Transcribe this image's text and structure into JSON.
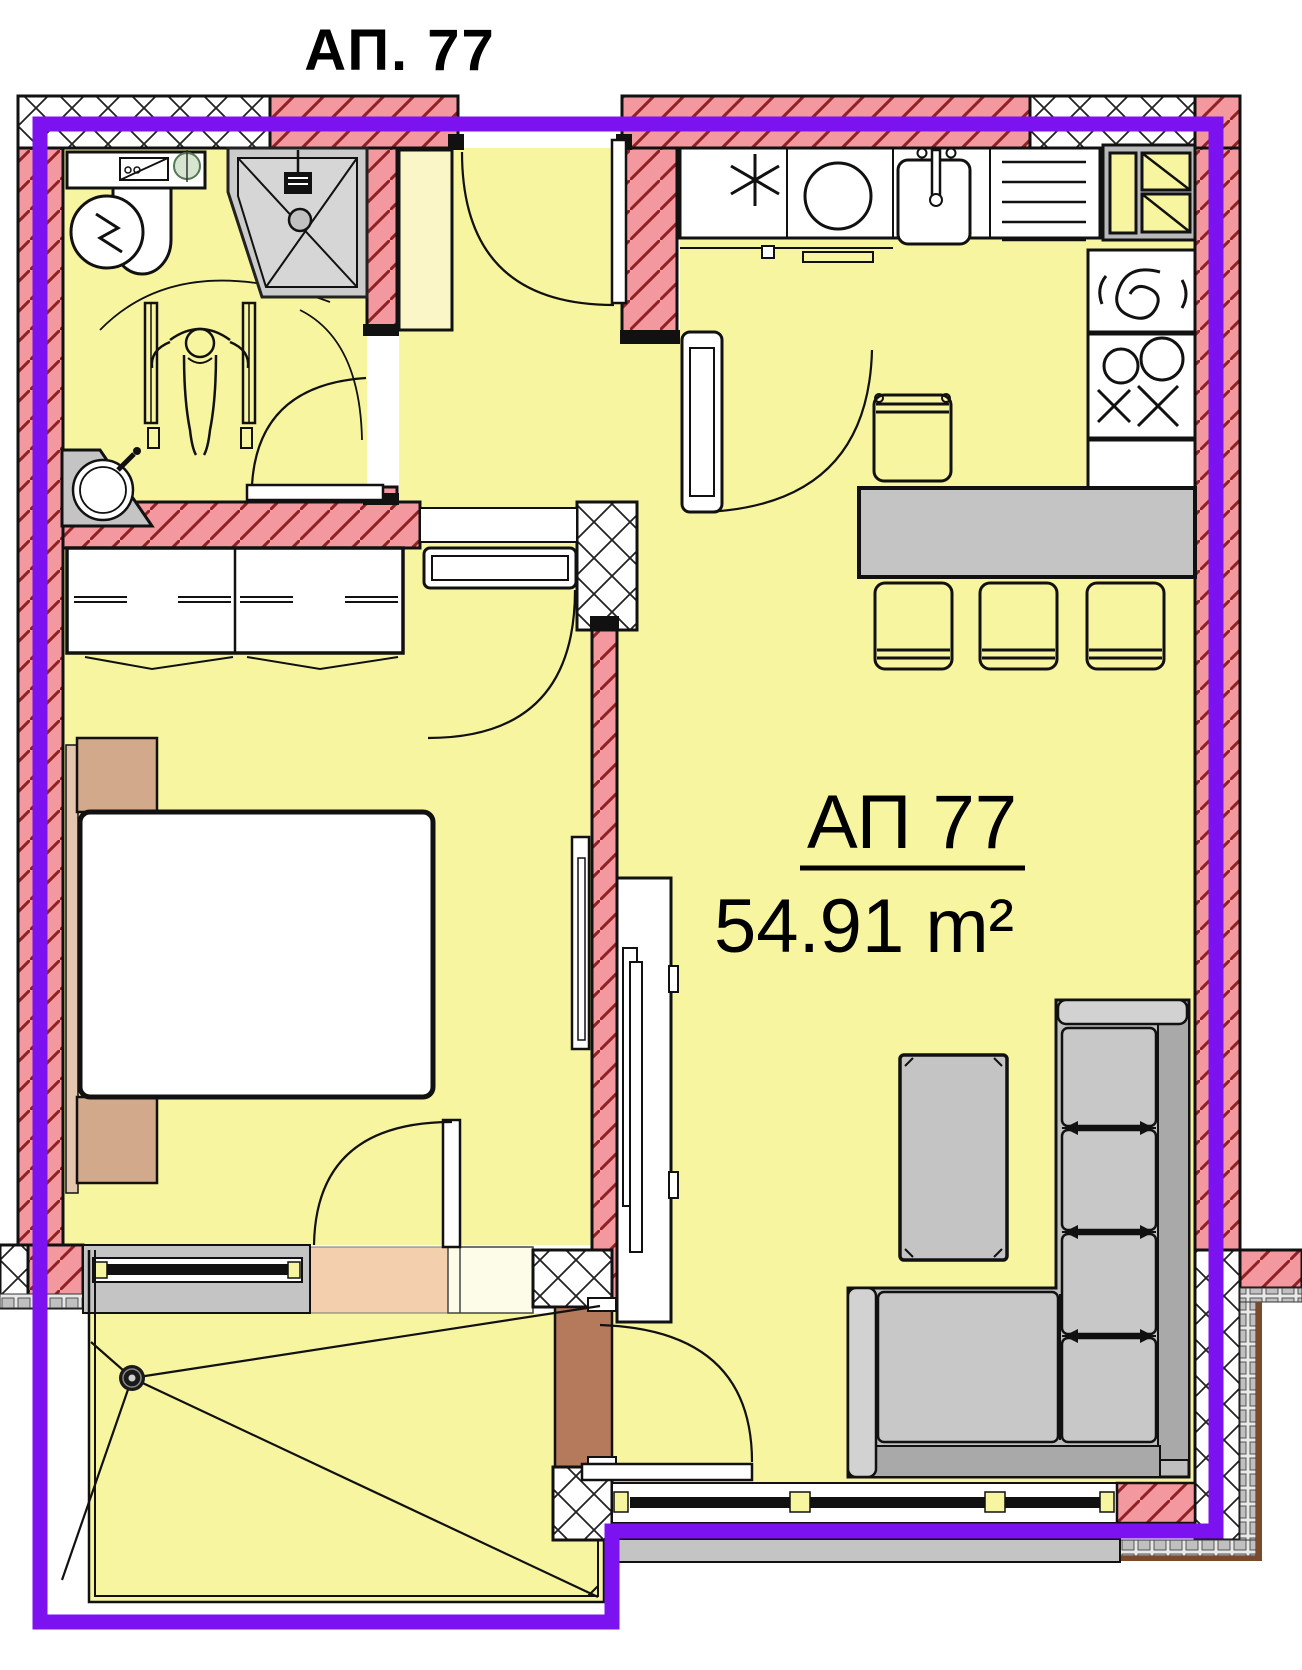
{
  "title": "АП. 77",
  "unit": {
    "name": "АП 77",
    "area": "54.91 m²"
  },
  "colors": {
    "boundary_purple": "#7d12f0",
    "wall_pink": "#f2989e",
    "hatch_red": "#8f2024",
    "floor_yellow": "#f8f5a1",
    "pale_cabinet_yellow": "#faf6c8",
    "fixture_gray": "#c4c4c4",
    "sofa_gray": "#bfbfbf",
    "furniture_tan": "#d3a98c",
    "door_brown": "#b5795b",
    "threshold_peach": "#f3cfae",
    "insulation_gray": "#c8c8c8",
    "outline_black": "#111111"
  }
}
